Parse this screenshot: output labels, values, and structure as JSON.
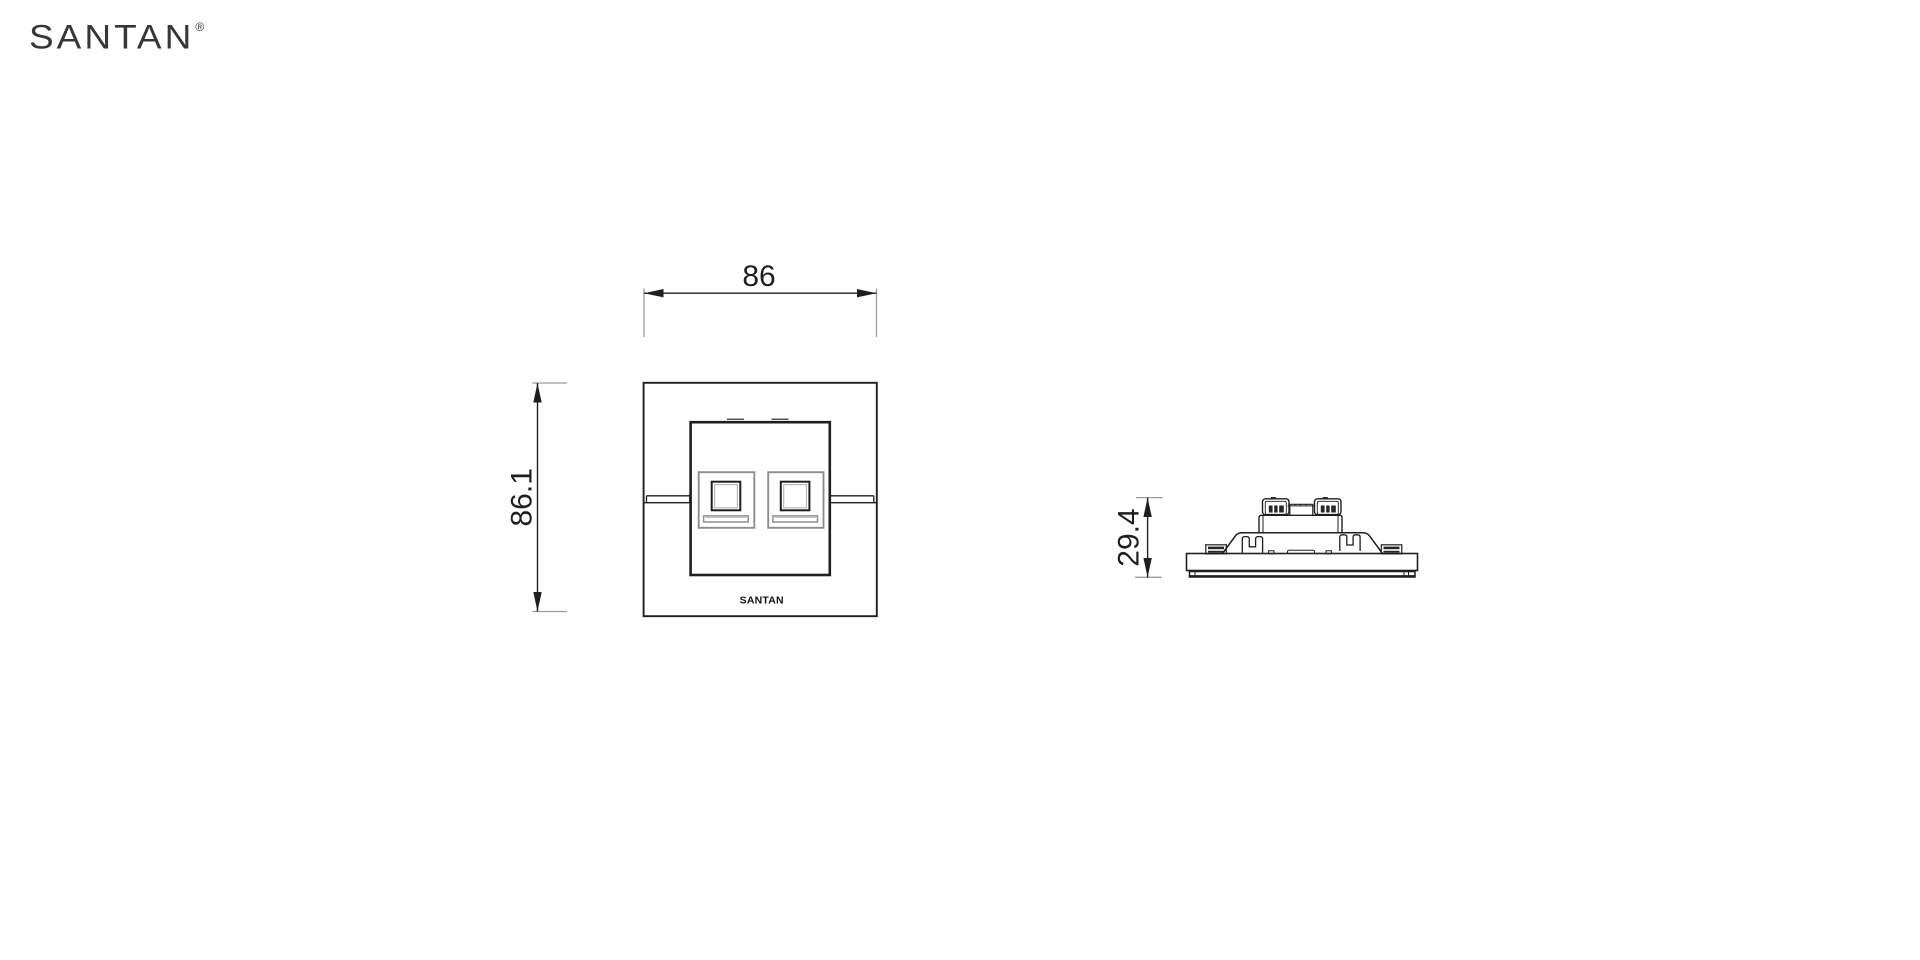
{
  "brand": {
    "logo_text": "SANTAN",
    "registered_mark": "®"
  },
  "views": {
    "front": {
      "width_dim": "86",
      "height_dim": "86.1",
      "plate_logo": "SANTAN"
    },
    "side": {
      "height_dim": "29.4"
    }
  },
  "colors": {
    "line": "#1f1f1f",
    "extension_line": "#9c9c9c",
    "module_gray": "#8d8d8d",
    "dark_fill": "#262626",
    "brand_text": "#3a3536",
    "background": "#ffffff"
  }
}
